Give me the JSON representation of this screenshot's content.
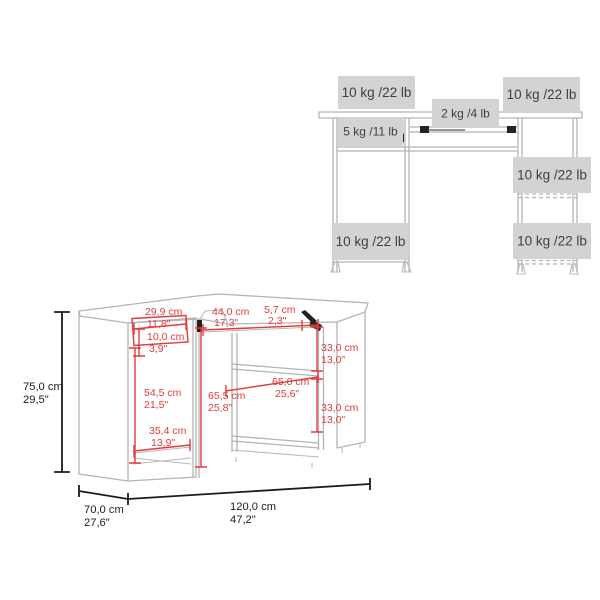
{
  "weight_diagram": {
    "labels": {
      "desktop_left": "10 kg /22 lb",
      "keyboard_tray": "2 kg /4 lb",
      "desktop_right": "10 kg /22 lb",
      "drawer": "5 kg /11 lb",
      "right_shelf_middle": "10 kg /22 lb",
      "right_shelf_bottom": "10 kg /22 lb",
      "left_pedestal_bottom": "10 kg /22 lb"
    }
  },
  "dimension_diagram": {
    "overall": {
      "height": {
        "cm": "75,0 cm",
        "in": "29,5\""
      },
      "depth": {
        "cm": "70,0 cm",
        "in": "27,6\""
      },
      "width": {
        "cm": "120,0 cm",
        "in": "47,2\""
      }
    },
    "details": {
      "drawer_width": {
        "cm": "29,9 cm",
        "in": "11,8\""
      },
      "drawer_height": {
        "cm": "10,0 cm",
        "in": "3,9\""
      },
      "tray_width": {
        "cm": "44,0 cm",
        "in": "17,3\""
      },
      "corner_offset": {
        "cm": "5,7 cm",
        "in": "2,3\""
      },
      "left_cavity_height": {
        "cm": "54,5 cm",
        "in": "21,5\""
      },
      "left_cavity_width": {
        "cm": "35,4 cm",
        "in": "13,9\""
      },
      "center_height": {
        "cm": "65,5 cm",
        "in": "25,8\""
      },
      "shelf_width": {
        "cm": "65,0 cm",
        "in": "25,6\""
      },
      "shelf_space_top": {
        "cm": "33,0 cm",
        "in": "13,0\""
      },
      "shelf_space_bottom": {
        "cm": "33,0 cm",
        "in": "13,0\""
      }
    }
  },
  "colors": {
    "dimension_red": "#e03c3c",
    "desk_line_gray": "#b4b4b4",
    "label_box_gray": "#d3d3d3",
    "label_text_dark": "#3f3f3f",
    "black": "#1c1c1c"
  }
}
